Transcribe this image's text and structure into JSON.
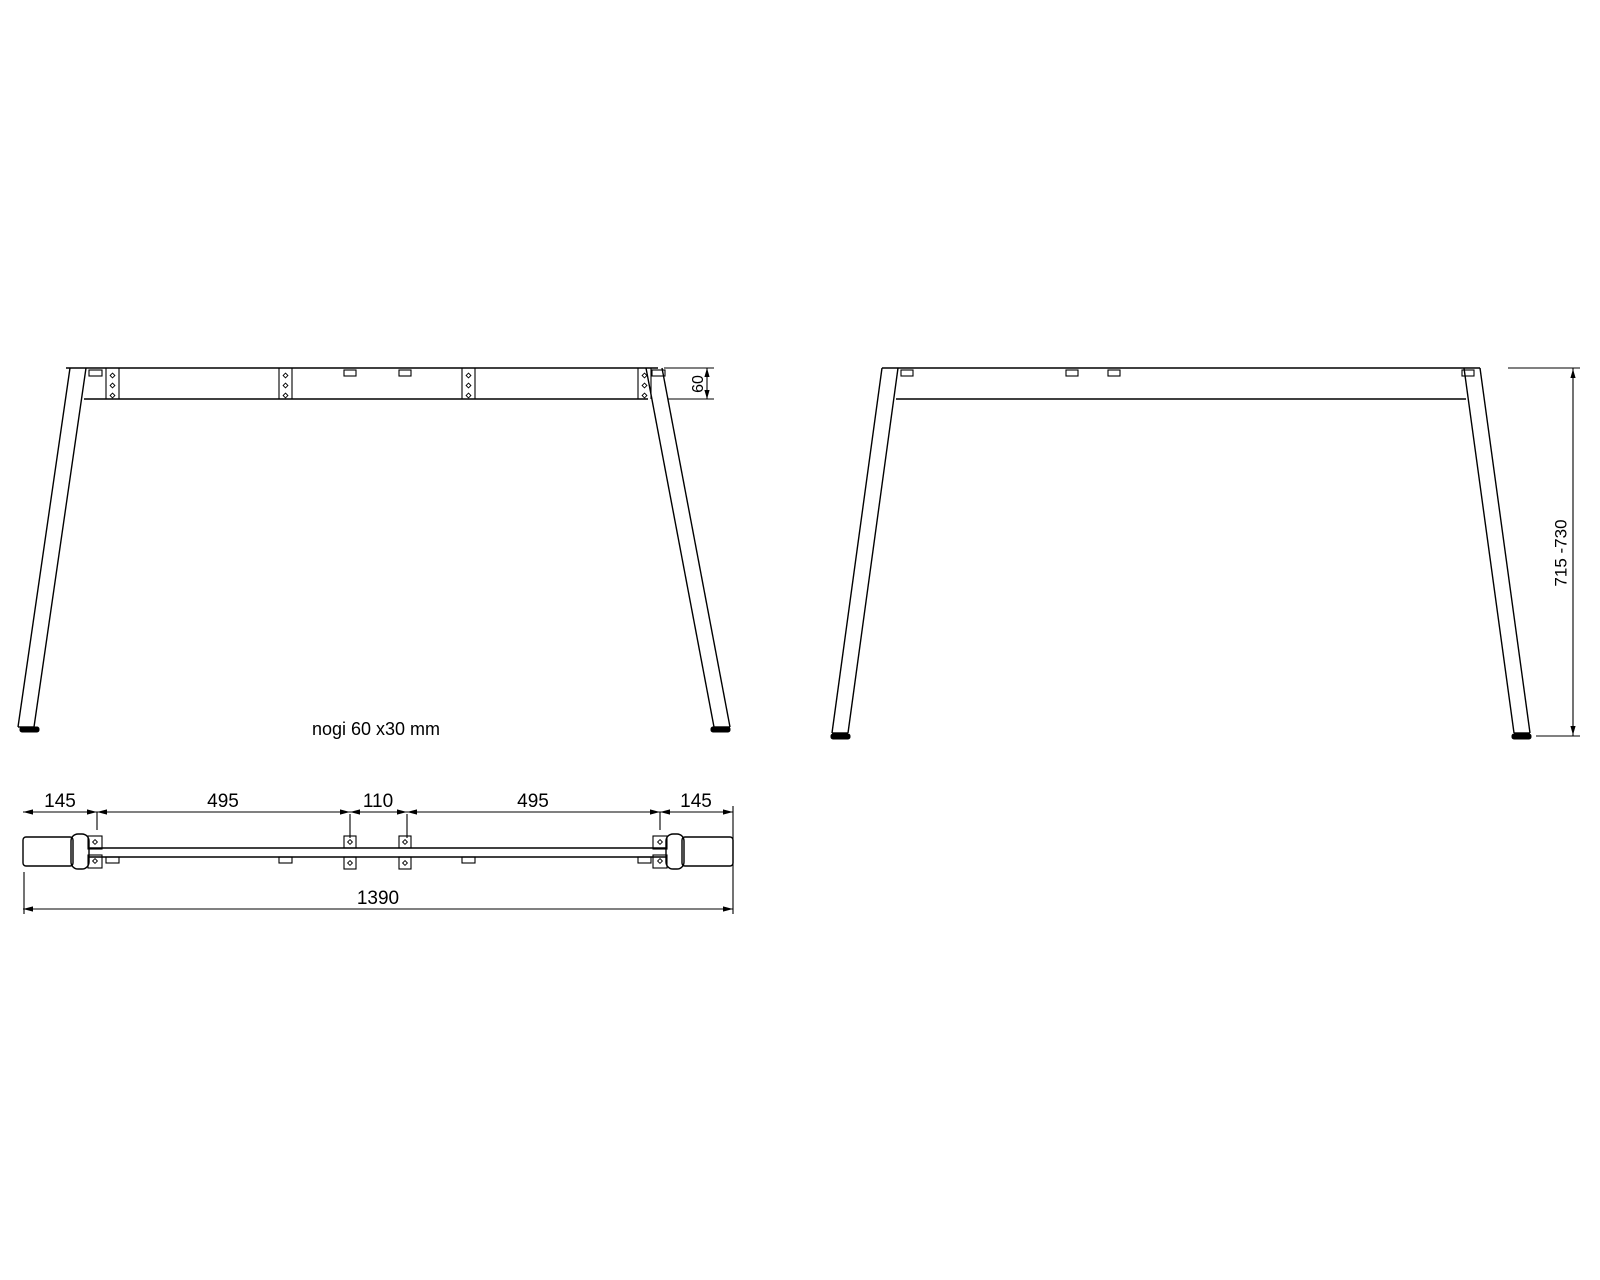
{
  "drawing": {
    "note": "nogi 60 x30 mm",
    "line_color": "#000000",
    "background_color": "#ffffff",
    "front_view": {
      "rail_height_label": "60"
    },
    "side_view": {
      "leg_height_range_label": "715 -730"
    },
    "plan_view": {
      "segment_labels": [
        "145",
        "495",
        "110",
        "495",
        "145"
      ],
      "total_width_label": "1390"
    }
  }
}
